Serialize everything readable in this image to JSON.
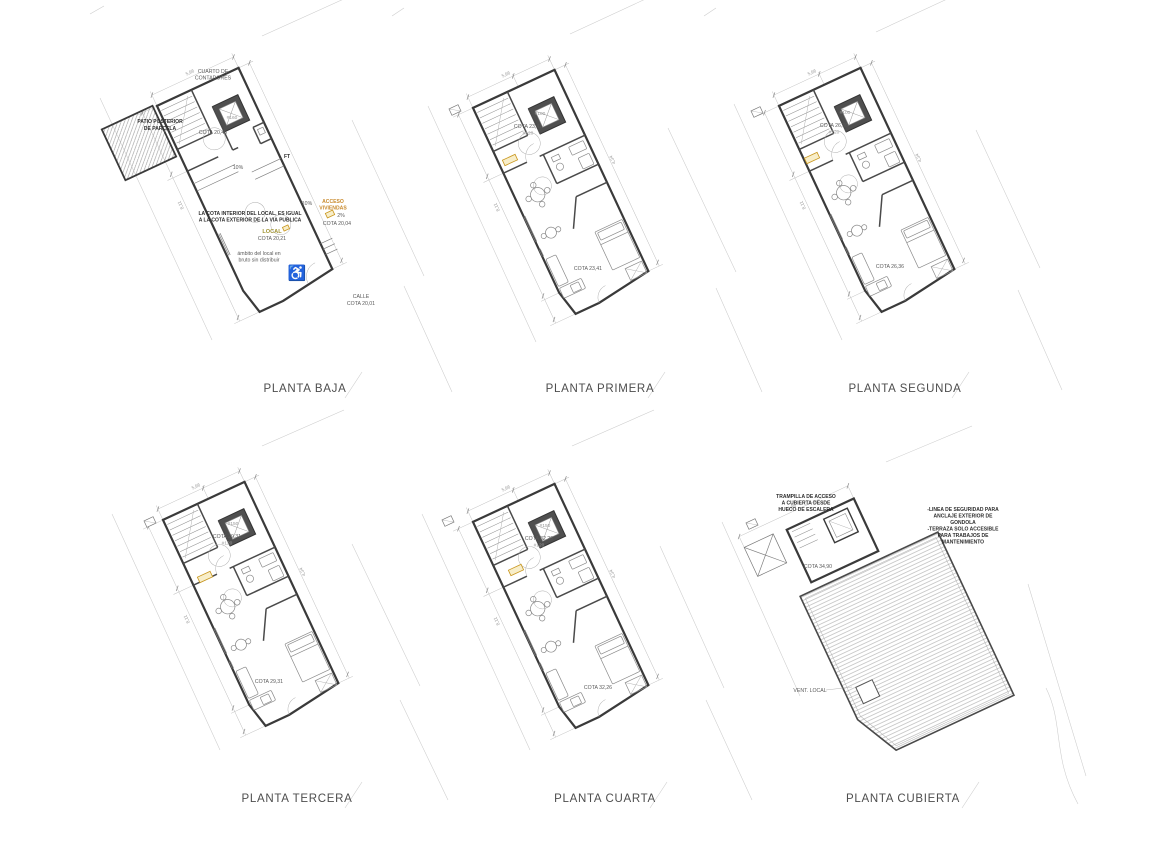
{
  "sheet": {
    "background": "#ffffff"
  },
  "colors": {
    "wall": "#3a3a3a",
    "line": "#7d7d7d",
    "dim": "#9a9a9a",
    "accent": "#c8892b",
    "olive": "#9f9232",
    "label": "#4d4d4d"
  },
  "icons": {
    "wheelchair": "♿"
  },
  "dims": {
    "w": "5,96",
    "d1": "8,11",
    "d2": "4,34"
  },
  "plans": {
    "baja": {
      "label": "PLANTA BAJA",
      "patio_line1": "PATIO POSTERIOR",
      "patio_line2": "DE PARCELA",
      "meters_line1": "CUARTO DE",
      "meters_line2": "CONTADORES",
      "code_top": "#160",
      "cota_top": "COTA 20,45",
      "ft": "FT",
      "ramp_a": "10%",
      "ramp_b": "10%",
      "note_line1": "LA COTA INTERIOR DEL LOCAL, ES IGUAL",
      "note_line2": "A LA COTA EXTERIOR DE LA VIA PUBLICA",
      "acceso_line1": "ACCESO",
      "acceso_line2": "VIVIENDAS",
      "acceso_pct": "2%",
      "cota_acceso": "COTA 20,04",
      "local": "LOCAL",
      "cota_local": "COTA 20,21",
      "ambito_line1": "ámbito del local en",
      "ambito_line2": "bruto sin distribuir",
      "calle": "CALLE",
      "cota_calle": "COTA 20,01"
    },
    "primera": {
      "label": "PLANTA PRIMERA",
      "code_top": "#100",
      "code_mid": "#120",
      "cota_top": "COTA 23,41",
      "cota_main": "COTA 23,41"
    },
    "segunda": {
      "label": "PLANTA SEGUNDA",
      "code_top": "#100",
      "code_mid": "#120",
      "cota_top": "COTA 26,36",
      "cota_main": "COTA 26,36"
    },
    "tercera": {
      "label": "PLANTA TERCERA",
      "code_top": "#150",
      "code_mid": "#120",
      "cota_top": "COTA 29,31",
      "cota_main": "COTA 29,31"
    },
    "cuarta": {
      "label": "PLANTA CUARTA",
      "code_top": "#150",
      "code_mid": "#120",
      "cota_top": "COTA 32,26",
      "cota_main": "COTA 32,26"
    },
    "cubierta": {
      "label": "PLANTA  CUBIERTA",
      "trampilla_line1": "TRAMPILLA DE ACCESO",
      "trampilla_line2": "A CUBIERTA DESDE",
      "trampilla_line3": "HUECO DE ESCALERA",
      "cota": "COTA 34,90",
      "nota_line1": "-LINEA DE SEGURIDAD PARA",
      "nota_line2": "ANCLAJE EXTERIOR DE",
      "nota_line3": "GONDOLA",
      "nota_line4": "-TERRAZA SOLO ACCESIBLE",
      "nota_line5": "PARA TRABAJOS DE",
      "nota_line6": "MANTENIMIENTO",
      "vent": "VENT. LOCAL"
    }
  }
}
